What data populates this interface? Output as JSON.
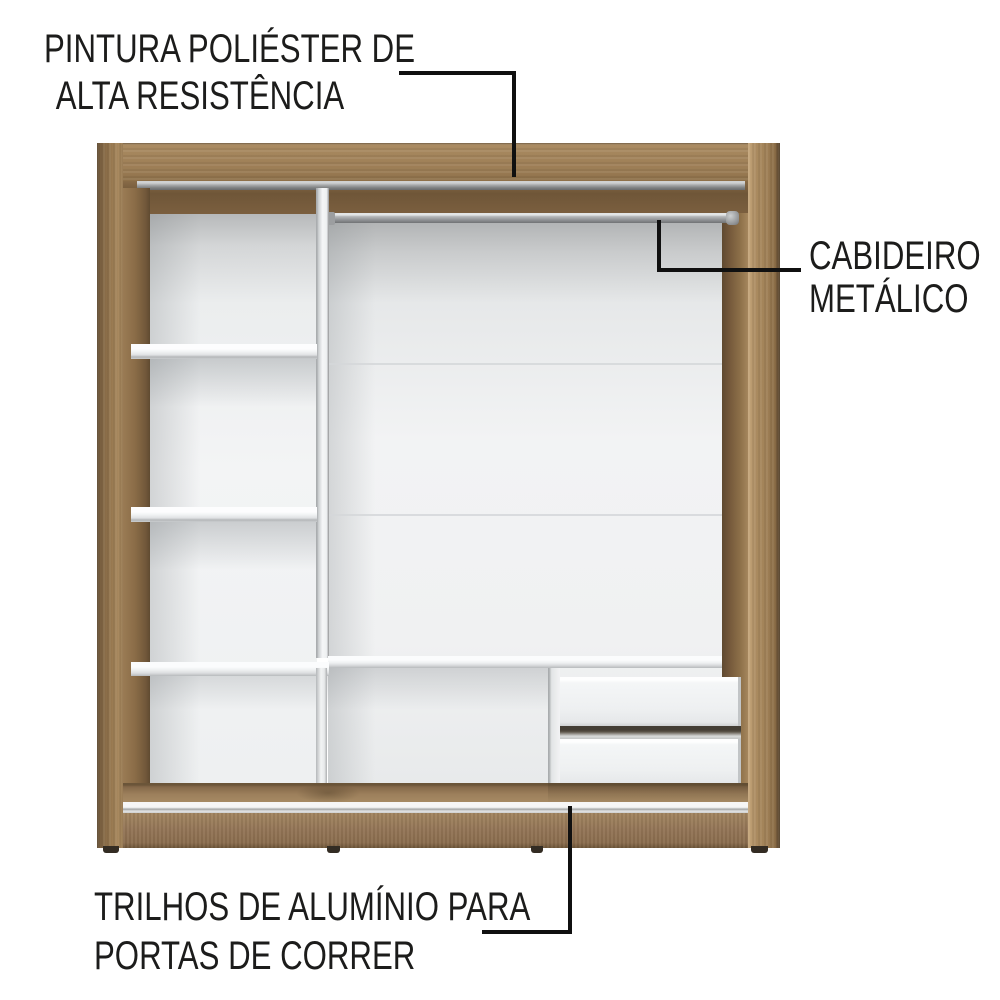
{
  "background": "#ffffff",
  "annotations": {
    "paint": {
      "line1": "PINTURA POLIÉSTER DE",
      "line2": "ALTA RESISTÊNCIA",
      "target": "top-panel"
    },
    "rod": {
      "line1": "CABIDEIRO",
      "line2": "METÁLICO",
      "target": "hanging-rod"
    },
    "rails": {
      "line1": "TRILHOS DE ALUMÍNIO PARA",
      "line2": "PORTAS DE CORRER",
      "target": "aluminum-rails"
    }
  },
  "colors": {
    "wood_frame": "#a08157",
    "wood_interior_dark": "#6f5638",
    "interior_panel_white": "#f0f1f2",
    "metal_grey": "#a9abad",
    "rail_aluminum": "#e8e9e9",
    "callout_line": "#101010",
    "label_text": "#1c1c1b"
  }
}
